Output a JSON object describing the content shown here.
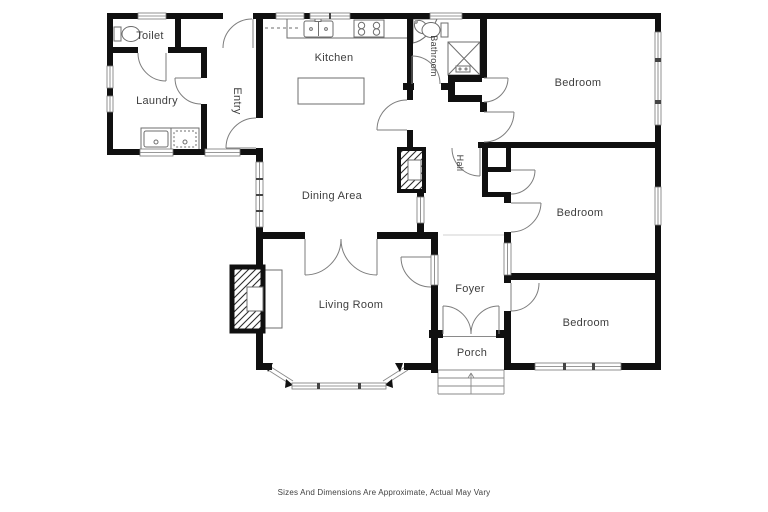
{
  "floor_plan": {
    "rooms": [
      {
        "id": "toilet",
        "label": "Toilet"
      },
      {
        "id": "laundry",
        "label": "Laundry"
      },
      {
        "id": "entry",
        "label": "Entry",
        "orientation": "vertical"
      },
      {
        "id": "kitchen",
        "label": "Kitchen"
      },
      {
        "id": "bathroom",
        "label": "Bathroom",
        "orientation": "vertical"
      },
      {
        "id": "hall",
        "label": "Hall",
        "orientation": "vertical"
      },
      {
        "id": "dining-area",
        "label": "Dining Area"
      },
      {
        "id": "living-room",
        "label": "Living Room"
      },
      {
        "id": "foyer",
        "label": "Foyer"
      },
      {
        "id": "porch",
        "label": "Porch"
      },
      {
        "id": "bedroom-top",
        "label": "Bedroom"
      },
      {
        "id": "bedroom-middle",
        "label": "Bedroom"
      },
      {
        "id": "bedroom-bottom",
        "label": "Bedroom"
      }
    ],
    "disclaimer": "Sizes And Dimensions Are Approximate, Actual May Vary",
    "fixture_icons": [
      "toilet-icon",
      "laundry-tubs-icon",
      "kitchen-sink-icon",
      "stove-icon",
      "kitchen-island-icon",
      "corner-sink-icon",
      "shower-icon",
      "fireplace-icon",
      "bay-window-icon",
      "porch-steps-icon",
      "door-swing-icon",
      "window-icon"
    ],
    "colors": {
      "wall": "#101010",
      "fixture_line": "#6e6e6e",
      "label_text": "#3e3e3e",
      "background": "#ffffff"
    }
  }
}
